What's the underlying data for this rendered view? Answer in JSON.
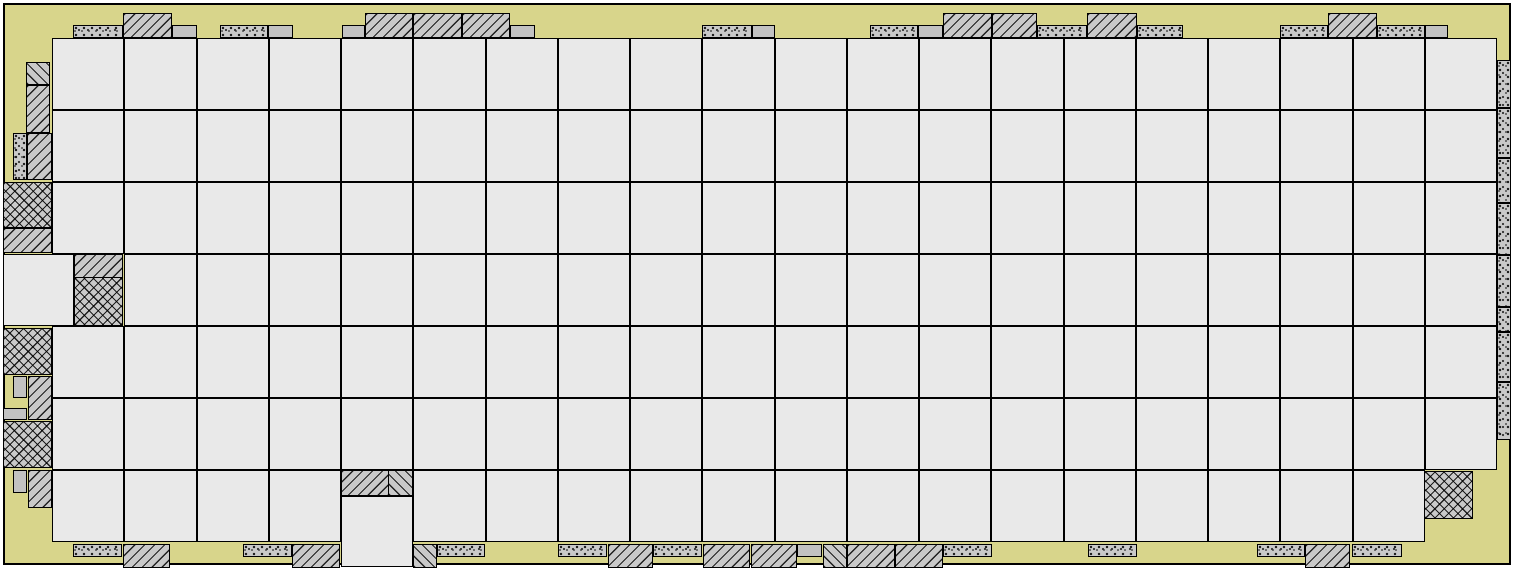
{
  "diagram": {
    "kind": "fpga-floorplan",
    "canvas": {
      "w": 1519,
      "h": 570
    }
  },
  "colors": {
    "page": "#ffffff",
    "die_fill": "#d8d58b",
    "tile_fill": "#e9e9e9",
    "pad_gray": "#c9c9c9",
    "plain_gray": "#c2c2c2",
    "line": "#000000"
  },
  "die": {
    "x": 3,
    "y": 3,
    "w": 1508,
    "h": 562
  },
  "grid": {
    "x": 52,
    "y": 38,
    "cols": 20,
    "rows": 7,
    "cell_w": 72.25,
    "cell_h": 72,
    "skip": [
      [
        3,
        0
      ],
      [
        6,
        4
      ],
      [
        6,
        19
      ]
    ]
  },
  "extra_tiles": [
    {
      "x": 3,
      "y": 254,
      "w": 71,
      "h": 72
    },
    {
      "x": 341,
      "y": 496,
      "w": 72,
      "h": 71
    }
  ],
  "pads": {
    "top": [
      {
        "x": 73,
        "y": 25,
        "w": 50,
        "h": 13,
        "p": "stipple"
      },
      {
        "x": 123,
        "y": 13,
        "w": 49,
        "h": 25,
        "p": "hatch"
      },
      {
        "x": 172,
        "y": 25,
        "w": 25,
        "h": 13,
        "p": "plain"
      },
      {
        "x": 220,
        "y": 25,
        "w": 48,
        "h": 13,
        "p": "stipple"
      },
      {
        "x": 268,
        "y": 25,
        "w": 25,
        "h": 13,
        "p": "plain"
      },
      {
        "x": 342,
        "y": 25,
        "w": 23,
        "h": 13,
        "p": "plain"
      },
      {
        "x": 365,
        "y": 13,
        "w": 48,
        "h": 25,
        "p": "hatch"
      },
      {
        "x": 413,
        "y": 13,
        "w": 49,
        "h": 25,
        "p": "hatch"
      },
      {
        "x": 462,
        "y": 13,
        "w": 48,
        "h": 25,
        "p": "hatch"
      },
      {
        "x": 510,
        "y": 25,
        "w": 25,
        "h": 13,
        "p": "plain"
      },
      {
        "x": 702,
        "y": 25,
        "w": 50,
        "h": 13,
        "p": "stipple"
      },
      {
        "x": 752,
        "y": 25,
        "w": 23,
        "h": 13,
        "p": "plain"
      },
      {
        "x": 870,
        "y": 25,
        "w": 48,
        "h": 13,
        "p": "stipple"
      },
      {
        "x": 918,
        "y": 25,
        "w": 25,
        "h": 13,
        "p": "plain"
      },
      {
        "x": 943,
        "y": 13,
        "w": 49,
        "h": 25,
        "p": "hatch"
      },
      {
        "x": 992,
        "y": 13,
        "w": 45,
        "h": 25,
        "p": "hatch"
      },
      {
        "x": 1037,
        "y": 25,
        "w": 50,
        "h": 13,
        "p": "stipple"
      },
      {
        "x": 1087,
        "y": 13,
        "w": 50,
        "h": 25,
        "p": "hatch"
      },
      {
        "x": 1137,
        "y": 25,
        "w": 46,
        "h": 13,
        "p": "stipple"
      },
      {
        "x": 1280,
        "y": 25,
        "w": 48,
        "h": 13,
        "p": "stipple"
      },
      {
        "x": 1328,
        "y": 13,
        "w": 49,
        "h": 25,
        "p": "hatch"
      },
      {
        "x": 1377,
        "y": 25,
        "w": 48,
        "h": 13,
        "p": "stipple"
      },
      {
        "x": 1425,
        "y": 25,
        "w": 23,
        "h": 13,
        "p": "plain"
      }
    ],
    "bottom": [
      {
        "x": 73,
        "y": 544,
        "w": 49,
        "h": 13,
        "p": "stipple"
      },
      {
        "x": 123,
        "y": 544,
        "w": 47,
        "h": 24,
        "p": "hatch"
      },
      {
        "x": 243,
        "y": 544,
        "w": 49,
        "h": 13,
        "p": "stipple"
      },
      {
        "x": 292,
        "y": 544,
        "w": 48,
        "h": 24,
        "p": "hatch"
      },
      {
        "x": 413,
        "y": 544,
        "w": 24,
        "h": 24,
        "p": "bhatch"
      },
      {
        "x": 437,
        "y": 544,
        "w": 48,
        "h": 13,
        "p": "stipple"
      },
      {
        "x": 558,
        "y": 544,
        "w": 49,
        "h": 13,
        "p": "stipple"
      },
      {
        "x": 608,
        "y": 544,
        "w": 45,
        "h": 24,
        "p": "hatch"
      },
      {
        "x": 653,
        "y": 544,
        "w": 49,
        "h": 13,
        "p": "stipple"
      },
      {
        "x": 703,
        "y": 544,
        "w": 47,
        "h": 24,
        "p": "hatch"
      },
      {
        "x": 751,
        "y": 544,
        "w": 46,
        "h": 24,
        "p": "hatch"
      },
      {
        "x": 797,
        "y": 544,
        "w": 25,
        "h": 13,
        "p": "plain"
      },
      {
        "x": 823,
        "y": 544,
        "w": 24,
        "h": 24,
        "p": "bhatch"
      },
      {
        "x": 847,
        "y": 544,
        "w": 48,
        "h": 24,
        "p": "hatch"
      },
      {
        "x": 895,
        "y": 544,
        "w": 48,
        "h": 24,
        "p": "hatch"
      },
      {
        "x": 943,
        "y": 544,
        "w": 49,
        "h": 13,
        "p": "stipple"
      },
      {
        "x": 1088,
        "y": 544,
        "w": 49,
        "h": 13,
        "p": "stipple"
      },
      {
        "x": 1257,
        "y": 544,
        "w": 48,
        "h": 13,
        "p": "stipple"
      },
      {
        "x": 1305,
        "y": 544,
        "w": 45,
        "h": 24,
        "p": "hatch"
      },
      {
        "x": 1352,
        "y": 544,
        "w": 50,
        "h": 13,
        "p": "stipple"
      }
    ],
    "left": [
      {
        "x": 26,
        "y": 62,
        "w": 24,
        "h": 23,
        "p": "bhatch"
      },
      {
        "x": 26,
        "y": 85,
        "w": 24,
        "h": 48,
        "p": "hatch"
      },
      {
        "x": 13,
        "y": 133,
        "w": 14,
        "h": 47,
        "p": "stipple"
      },
      {
        "x": 27,
        "y": 133,
        "w": 25,
        "h": 47,
        "p": "hatch"
      },
      {
        "x": 3,
        "y": 182,
        "w": 49,
        "h": 46,
        "p": "cross"
      },
      {
        "x": 3,
        "y": 228,
        "w": 49,
        "h": 25,
        "p": "hatch"
      },
      {
        "x": 3,
        "y": 328,
        "w": 49,
        "h": 47,
        "p": "cross"
      },
      {
        "x": 13,
        "y": 376,
        "w": 14,
        "h": 22,
        "p": "plain"
      },
      {
        "x": 28,
        "y": 376,
        "w": 24,
        "h": 44,
        "p": "hatch"
      },
      {
        "x": 3,
        "y": 408,
        "w": 24,
        "h": 12,
        "p": "plain"
      },
      {
        "x": 3,
        "y": 421,
        "w": 49,
        "h": 47,
        "p": "cross"
      },
      {
        "x": 13,
        "y": 470,
        "w": 14,
        "h": 23,
        "p": "plain"
      },
      {
        "x": 28,
        "y": 470,
        "w": 24,
        "h": 38,
        "p": "hatch"
      }
    ],
    "right": [
      {
        "x": 1497,
        "y": 60,
        "w": 14,
        "h": 48,
        "p": "stipple"
      },
      {
        "x": 1497,
        "y": 108,
        "w": 14,
        "h": 50,
        "p": "stipple"
      },
      {
        "x": 1497,
        "y": 158,
        "w": 14,
        "h": 45,
        "p": "stipple"
      },
      {
        "x": 1497,
        "y": 203,
        "w": 14,
        "h": 52,
        "p": "stipple"
      },
      {
        "x": 1497,
        "y": 255,
        "w": 14,
        "h": 52,
        "p": "stipple"
      },
      {
        "x": 1497,
        "y": 307,
        "w": 14,
        "h": 25,
        "p": "stipple"
      },
      {
        "x": 1497,
        "y": 332,
        "w": 14,
        "h": 50,
        "p": "stipple"
      },
      {
        "x": 1497,
        "y": 382,
        "w": 14,
        "h": 58,
        "p": "stipple"
      }
    ],
    "inner": [
      {
        "x": 74,
        "y": 254,
        "w": 49,
        "h": 24,
        "p": "hatch"
      },
      {
        "x": 74,
        "y": 277,
        "w": 49,
        "h": 49,
        "p": "cross"
      },
      {
        "x": 341,
        "y": 470,
        "w": 48,
        "h": 26,
        "p": "hatch"
      },
      {
        "x": 388,
        "y": 470,
        "w": 25,
        "h": 26,
        "p": "bhatch"
      },
      {
        "x": 1424,
        "y": 471,
        "w": 49,
        "h": 48,
        "p": "cross"
      }
    ]
  }
}
